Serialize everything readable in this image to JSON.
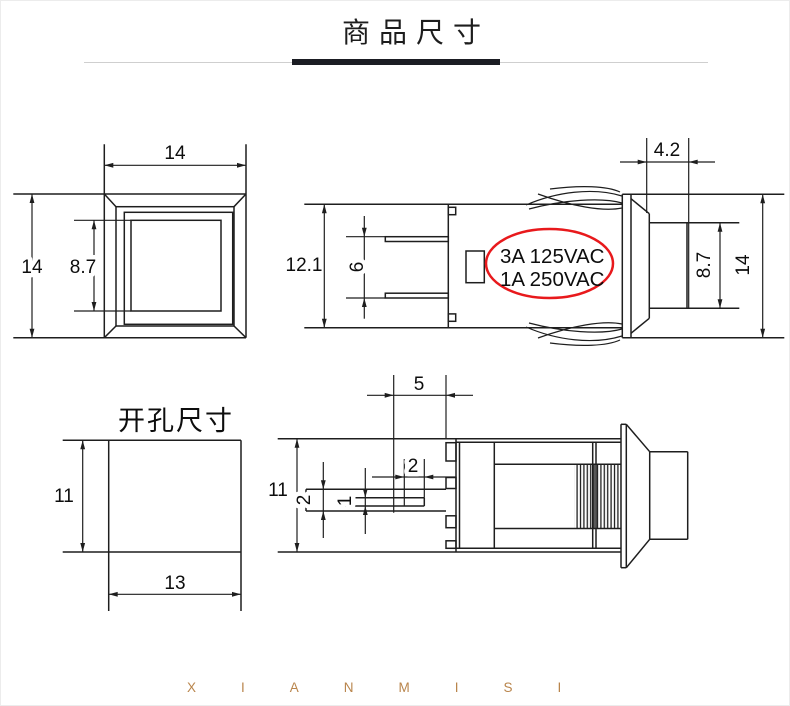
{
  "header": {
    "title": "商品尺寸"
  },
  "front_view": {
    "width": "14",
    "height": "14",
    "button_face": "8.7"
  },
  "side_view": {
    "body_height": "12.1",
    "pin_span": "6",
    "cap_protrusion": "4.2",
    "cap_height": "8.7",
    "bezel_height": "14",
    "rating_line1": "3A 125VAC",
    "rating_line2": "1A 250VAC",
    "rating_color": "#e8191c"
  },
  "hole_view": {
    "title": "开孔尺寸",
    "height": "11",
    "width": "13"
  },
  "top_view": {
    "body_width": "11",
    "hole_to_face": "5",
    "slot_length": "2",
    "pin_width": "2",
    "pin_thickness": "1"
  },
  "watermark": {
    "text": "XIANMISI",
    "color": "#b9854c"
  }
}
